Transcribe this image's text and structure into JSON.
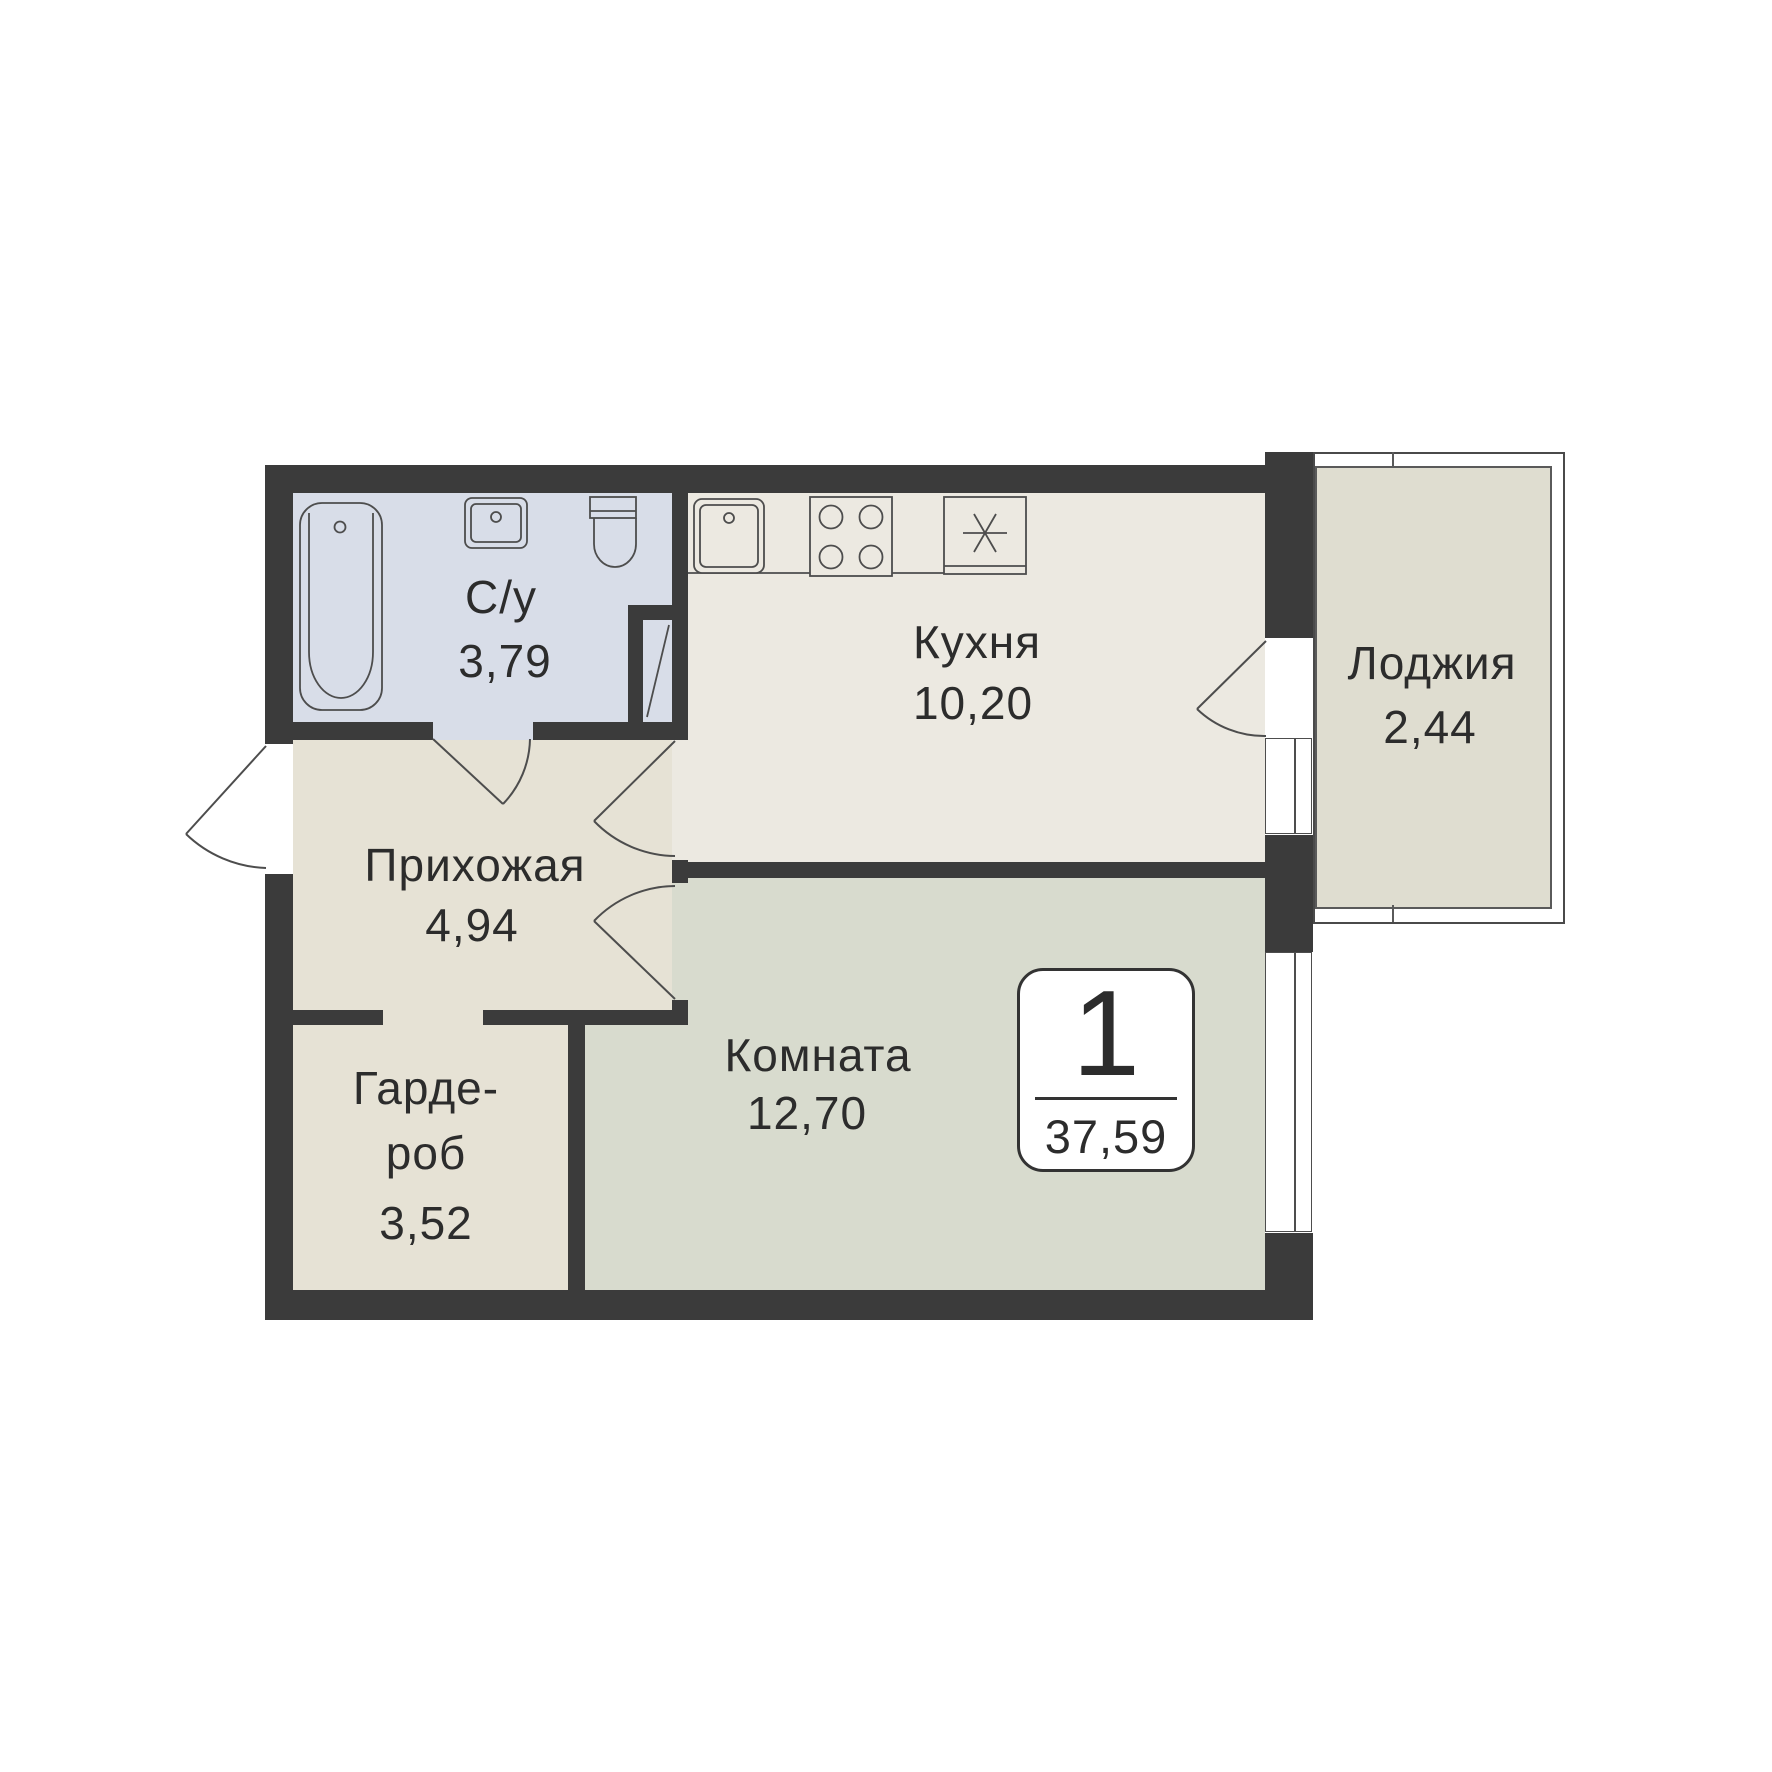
{
  "plan": {
    "kind": "apartment-floor-plan",
    "rooms": {
      "bathroom": {
        "label": "С/у",
        "area": "3,79"
      },
      "kitchen": {
        "label": "Кухня",
        "area": "10,20"
      },
      "loggia": {
        "label": "Лоджия",
        "area": "2,44"
      },
      "hallway": {
        "label": "Прихожая",
        "area": "4,94"
      },
      "wardrobe": {
        "label_line1": "Гарде-",
        "label_line2": "роб",
        "area": "3,52"
      },
      "room": {
        "label": "Комната",
        "area": "12,70"
      }
    },
    "badge": {
      "room_count": "1",
      "total_area": "37,59"
    },
    "fixtures": [
      "bathtub-icon",
      "bath-sink-icon",
      "toilet-icon",
      "vent-shaft-icon",
      "kitchen-sink-icon",
      "stove-icon",
      "fridge-icon"
    ],
    "doors": [
      "entry-door",
      "bathroom-door",
      "kitchen-door",
      "room-door",
      "loggia-door"
    ],
    "colors": {
      "wall": "#3b3b3b",
      "bathroom_fill": "#d8dde8",
      "kitchen_fill": "#ece9e1",
      "hallway_fill": "#e6e2d5",
      "room_fill": "#d8dbce",
      "loggia_fill": "#dfddd0",
      "line": "#4d4d4d",
      "text": "#2c2c2c"
    }
  }
}
